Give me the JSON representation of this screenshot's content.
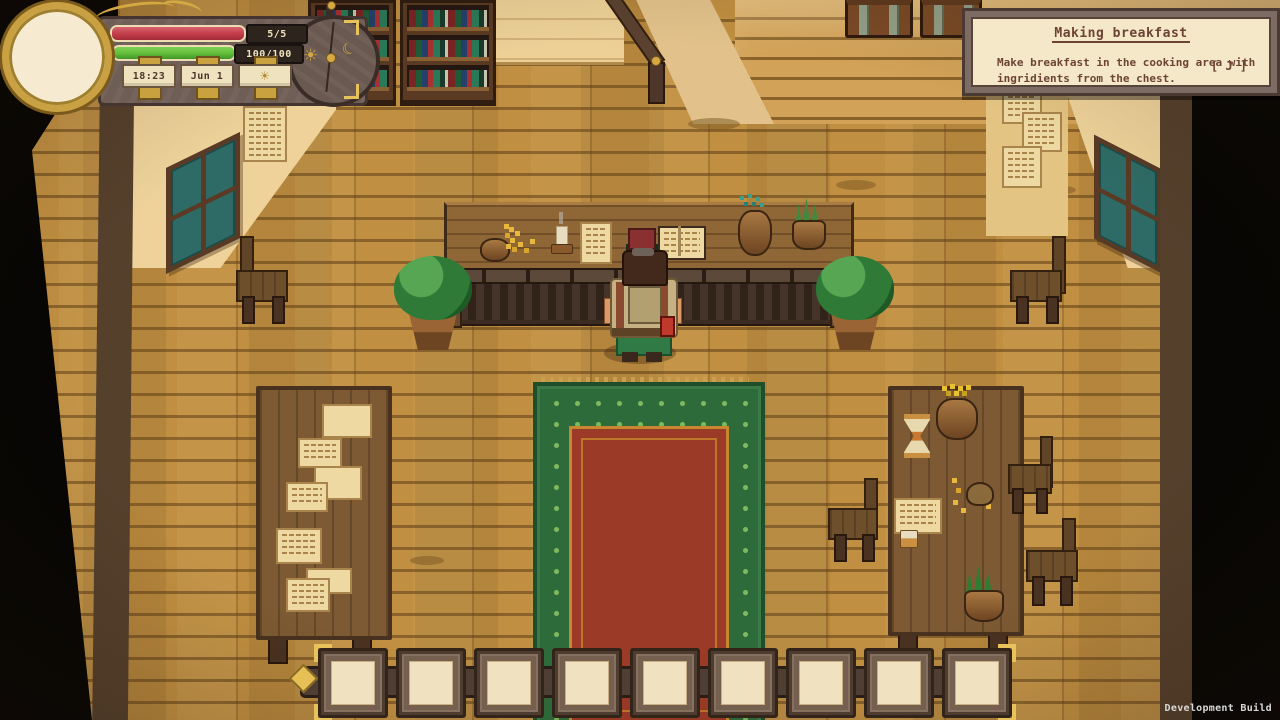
{
  "hud": {
    "health": {
      "label": "5/5",
      "fill_pct": 100,
      "color": "#c23c49"
    },
    "energy": {
      "label": "100/100",
      "fill_pct": 100,
      "color": "#62bd3a"
    },
    "time_label": "18:23",
    "date_label": "Jun 1",
    "weather": {
      "icon": "sunny-icon",
      "glyph": "☀"
    },
    "clock": {
      "sun_glyph": "☀",
      "moon_glyph": "☾"
    }
  },
  "quest_panel": {
    "title": "Making breakfast",
    "body_line1": "Make breakfast in the cooking area with",
    "body_line2": "ingridients from the chest.",
    "key_hint": "[ J ]"
  },
  "hotbar": {
    "slot_count": 9,
    "slots_empty": true
  },
  "footer": {
    "build_label": "Development Build"
  },
  "colors": {
    "gold": "#d9b35a",
    "hud_panel": "#6e5d55",
    "parchment": "#f3e7c7",
    "rug_green": "#2e6b3a",
    "rug_red": "#9b3a26",
    "floor": "#c08f41",
    "quest_text": "#6d4434"
  }
}
